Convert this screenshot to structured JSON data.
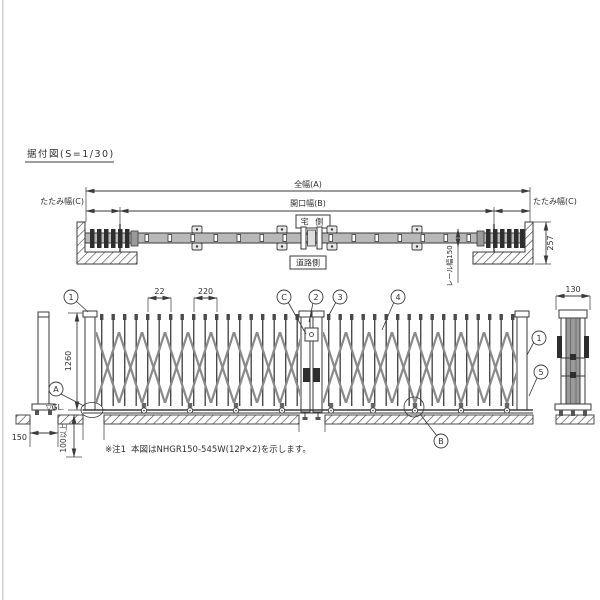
{
  "drawing": {
    "title": "据付図(S=1/30)",
    "note_prefix": "※注1",
    "note_body": "本図はNHGR150-545W(12P×2)を示します。"
  },
  "plan": {
    "dim_total_width": "全幅(A)",
    "dim_opening_width": "開口幅(B)",
    "dim_fold_width_left": "たたみ幅(C)",
    "dim_fold_width_right": "たたみ幅(C)",
    "label_house_side": "宅 側",
    "label_road_side": "道路側",
    "dim_rail_width": "レール幅150",
    "dim_depth": "257"
  },
  "elevation": {
    "dim_picket_gap": "22",
    "dim_pitch": "220",
    "dim_height": "1260",
    "dim_post_width": "130",
    "dim_footing_width": "150",
    "dim_embed_depth": "100以上",
    "label_ground_level": "▽GL."
  },
  "callouts": {
    "c1": "1",
    "c2": "2",
    "c3": "3",
    "c4": "4",
    "c5": "5",
    "ca": "A",
    "cb": "B",
    "cc": "C"
  },
  "colors": {
    "line": "#3a3a3a",
    "rail_fill": "#b8b8b8",
    "dark_fill": "#2e2e2e",
    "lattice": "#8a8a8a",
    "hatch": "#4a4a4a"
  }
}
